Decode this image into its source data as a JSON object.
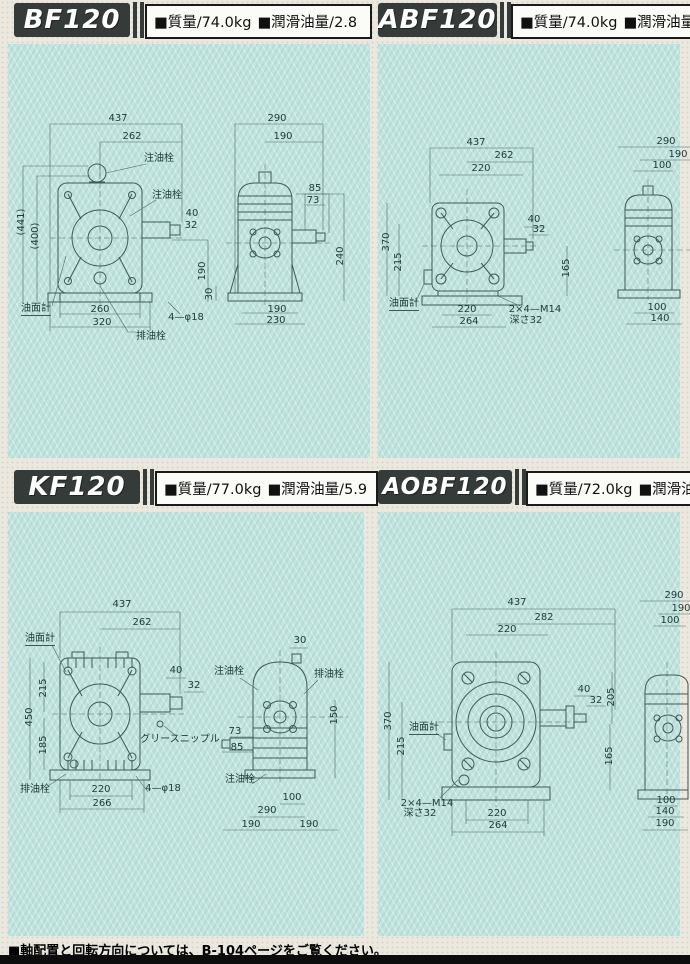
{
  "page": {
    "footer_note": "■軸配置と回転方向については、B-104ページをご覧ください。"
  },
  "panels": {
    "bf120": {
      "model": "BF120",
      "mass": "■質量/74.0kg",
      "oil": "■潤滑油量/2.8",
      "labels": {
        "oil_fill_top": "注油栓",
        "oil_fill_side": "注油栓",
        "oil_gauge": "油面計",
        "drain": "排油栓",
        "bolt_note": "4—φ18"
      },
      "front": {
        "w_total": "437",
        "w_inner": "262",
        "h_total": "(441)",
        "h_inner": "(400)",
        "shaft_l": "40",
        "shaft_d": "32",
        "base_h": "190",
        "base_w1": "260",
        "base_w2": "320"
      },
      "side": {
        "w_total": "290",
        "w_inner": "190",
        "shaft_l": "85",
        "shaft_d": "73",
        "h_total": "240",
        "base_off": "30",
        "base_w1": "190",
        "base_w2": "230"
      }
    },
    "abf120": {
      "model": "ABF120",
      "mass": "■質量/74.0kg",
      "oil": "■潤滑油量/2.8",
      "labels": {
        "oil_gauge": "油面計",
        "tap_note": "2×4—M14",
        "tap_depth": "深さ32"
      },
      "front": {
        "w_total": "437",
        "w_inner": "262",
        "w_top": "220",
        "h_total": "370",
        "h_inner": "215",
        "shaft_l": "40",
        "shaft_d": "32",
        "h_shaft": "165",
        "base_w1": "220",
        "base_w2": "264"
      },
      "side": {
        "w_total": "290",
        "w_inner": "190",
        "w_top": "100",
        "base_w1": "100",
        "base_w2": "140"
      }
    },
    "kf120": {
      "model": "KF120",
      "mass": "■質量/77.0kg",
      "oil": "■潤滑油量/5.9",
      "labels": {
        "oil_gauge": "油面計",
        "grease": "グリースニップル",
        "drain_front": "排油栓",
        "bolt_note": "4—φ18",
        "oil_fill_top": "注油栓",
        "drain_side": "排油栓",
        "oil_fill_bottom": "注油栓"
      },
      "front": {
        "w_total": "437",
        "w_inner": "262",
        "h1": "215",
        "h_total": "450",
        "h2": "185",
        "shaft_l": "40",
        "shaft_d": "32",
        "base_w1": "220",
        "base_w2": "266"
      },
      "side": {
        "top_off": "30",
        "shaft_d": "73",
        "shaft_l": "85",
        "h_right": "150",
        "base_w0": "100",
        "base_w1": "290",
        "base_wl": "190",
        "base_wr": "190"
      }
    },
    "aobf120": {
      "model": "AOBF120",
      "mass": "■質量/72.0kg",
      "oil": "■潤滑油量/2.8",
      "labels": {
        "oil_gauge": "油面計",
        "tap_note": "2×4—M14",
        "tap_depth": "深さ32"
      },
      "front": {
        "w_total": "437",
        "w_inner": "282",
        "w_top": "220",
        "h_total": "370",
        "h_inner": "215",
        "shaft_l": "40",
        "shaft_d": "32",
        "h_shaft2": "205",
        "h_shaft": "165",
        "base_w1": "220",
        "base_w2": "264"
      },
      "side": {
        "w_total": "290",
        "w_inner": "190",
        "w_top": "100",
        "base_w0": "100",
        "base_w1": "140",
        "base_w2": "190"
      }
    }
  }
}
